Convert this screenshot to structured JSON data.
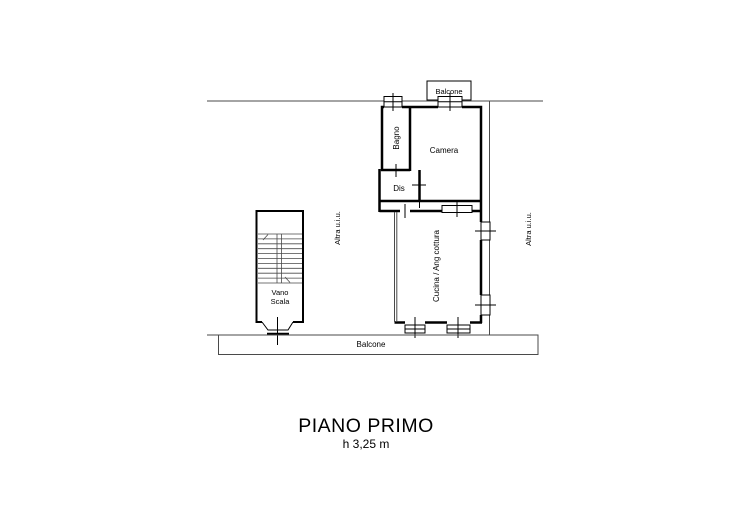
{
  "plan": {
    "title": "PIANO PRIMO",
    "subtitle": "h 3,25 m",
    "labels": {
      "balcone_top": "Balcone",
      "bagno": "Bagno",
      "camera": "Camera",
      "dis": "Dis",
      "cucina": "Cucina / Ang cottura",
      "vano_scala_line1": "Vano",
      "vano_scala_line2": "Scala",
      "altra_uiu_left": "Altra u.i.u.",
      "altra_uiu_right": "Altra u.i.u.",
      "balcone_bottom": "Balcone"
    },
    "colors": {
      "wall": "#000000",
      "thin_line": "#4a4a4a",
      "background": "#ffffff"
    }
  }
}
